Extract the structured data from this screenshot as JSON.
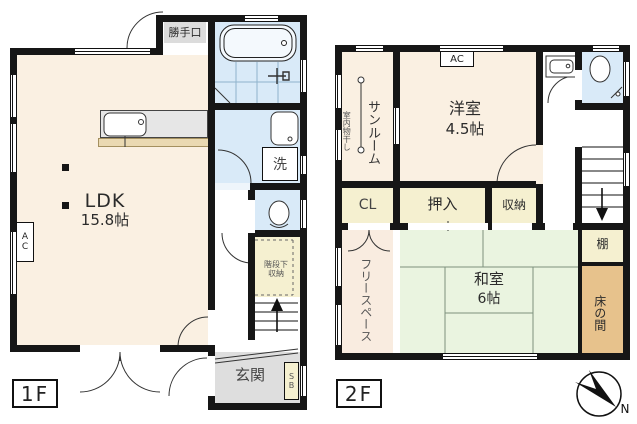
{
  "floor1": {
    "tag": "1F",
    "ldk_name": "LDK",
    "ldk_size": "15.8帖",
    "katteguchi": "勝手口",
    "washer": "洗",
    "genkan": "玄関",
    "shoe_box": "SB",
    "under_stair_line1": "階段下",
    "under_stair_line2": "収納",
    "ac": "AC"
  },
  "floor2": {
    "tag": "2F",
    "sunroom": "サンルーム",
    "indoor_drying": "室内物干し",
    "western_room_name": "洋室",
    "western_room_size": "4.5帖",
    "ac": "AC",
    "closet": "CL",
    "oshiire": "押入",
    "storage": "収納",
    "free_space": "フリースペース",
    "japanese_room_name": "和室",
    "japanese_room_size": "6帖",
    "shelf": "棚",
    "tokonoma": "床の間"
  },
  "compass": {
    "north": "N"
  },
  "colors": {
    "wall": "#161616",
    "room_cream": "#faf0e2",
    "wet_blue": "#d9eaf8",
    "closet_yellow": "#f5f0d0",
    "tatami_green": "#eaf4e0",
    "tokonoma_tan": "#e7c28c",
    "genkan_gray": "#dedede",
    "free_space_pink": "#f9ece0",
    "counter_gray": "#e6e6e6"
  }
}
